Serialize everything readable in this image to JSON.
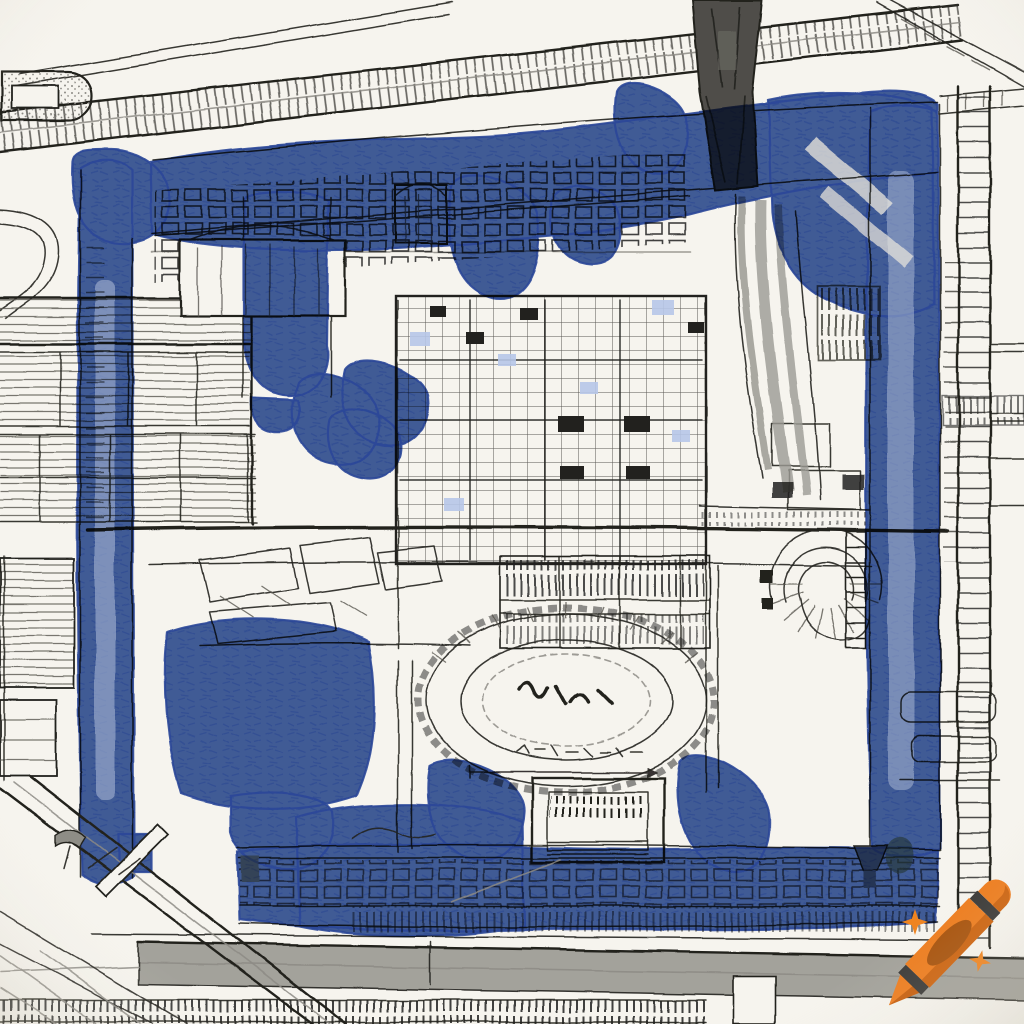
{
  "meta": {
    "description": "Hand-drawn pen-and-ink architectural site plan sketch of a large walled compound, highlighted with blue ink wash strips and tree blobs; diagonal railway lines at top, gray road at bottom, crayon watermark in lower right corner",
    "visible_text": "none (only illegible scribble marks)"
  },
  "palette": {
    "paper": "#f6f4ee",
    "ink": "#22211e",
    "ink_soft": "#57554f",
    "pencil_gray": "#8d8b85",
    "road_gray": "#a3a29b",
    "tower_gray": "#4f4e49",
    "wash_blue": "#5273c4",
    "wash_blue_dark": "#2c4ba4",
    "wash_blue_deep": "#24429c",
    "wash_blue_light": "#b7c7e8",
    "wash_olive": "#8b8a4e",
    "patch_tan": "#c8b28b",
    "crayon_orange": "#ed7d1f",
    "crayon_orange_dark": "#c75f0e",
    "crayon_stripe": "#3b3a38",
    "crayon_label": "#a8540e",
    "sparkle_orange": "#ef8420"
  },
  "watermark": {
    "icon": "crayon-icon",
    "sparkle_count": 2
  }
}
